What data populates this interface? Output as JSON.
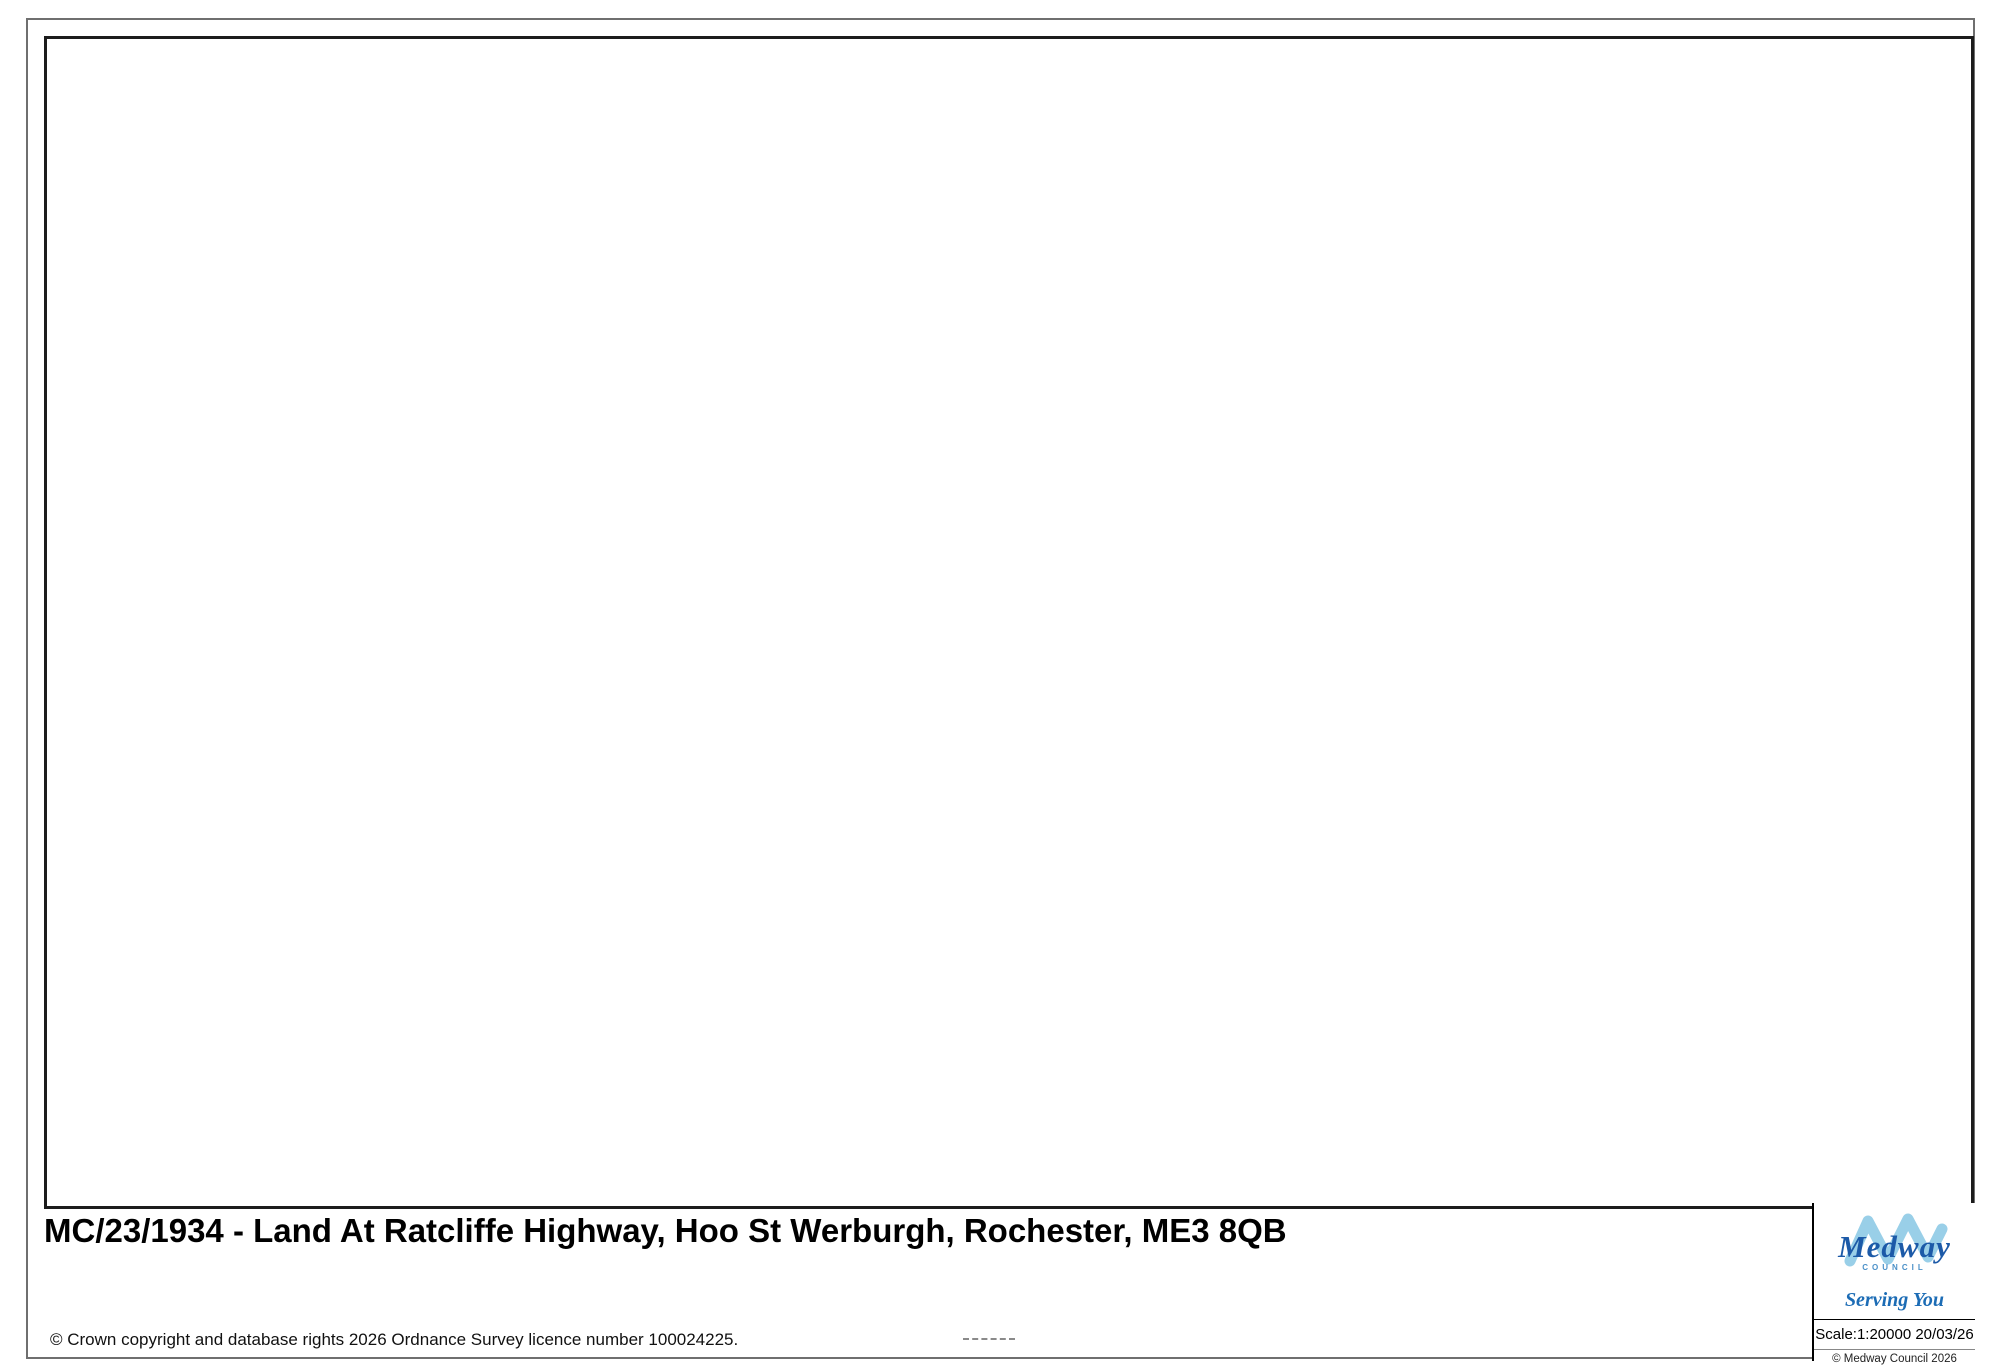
{
  "footer": {
    "title": "MC/23/1934 - Land At Ratcliffe Highway, Hoo St Werburgh, Rochester, ME3 8QB",
    "os_copyright": "© Crown copyright and database rights 2026 Ordnance Survey licence number 100024225.",
    "logo": {
      "name": "Medway",
      "council": "COUNCIL",
      "tagline": "Serving You"
    },
    "scale_text": "Scale:1:20000   20/03/26",
    "scale_label": "Scale:1:20000",
    "date": "20/03/26",
    "council_copyright": "© Medway Council 2026"
  },
  "compass": {
    "n": "N",
    "e": "E",
    "s": "S",
    "w": "W"
  },
  "site": {
    "reference": "MC/23/1934",
    "boundary_points": "967,531 1003,556 1015,559 1031,578 1057,568 1095,649 1013,673 1003,677 960,687 921,561",
    "boundary_color": "#e80012"
  },
  "parking": {
    "label": "P"
  },
  "route_badge": {
    "label": "179",
    "x": 888,
    "y": 883
  },
  "colors": {
    "grid": "#8fd9f2",
    "road_a": "#f170ab",
    "road_minor": "#fdf27b",
    "road_b": "#f5a95e",
    "woodland": "#e9f1db",
    "marsh": "#e6ead9",
    "water": "#d9edf7",
    "builtup": "#f8e7d1",
    "contour": "#f2c5a2",
    "label_grey": "#8c8c8c",
    "label_orange": "#ed9a66",
    "label_pink": "#ee5f9e",
    "route_dot": "#5fcfa5",
    "path_pink": "#f0569f"
  },
  "map": {
    "origin": {
      "x": 44,
      "y": 36
    },
    "labels": [
      {
        "t": "et",
        "x": 62,
        "y": 56,
        "s": 26
      },
      {
        "t": "MEDWAY",
        "x": 762,
        "y": 4,
        "s": 100,
        "ls": 26,
        "c": "#979797"
      },
      {
        "t": "Lodge Hill",
        "x": 327,
        "y": 101,
        "s": 27
      },
      {
        "t": "H O O",
        "x": 245,
        "y": 183,
        "s": 62,
        "ls": 22,
        "c": "#929292"
      },
      {
        "t": "P E N I N S U L A",
        "x": 783,
        "y": 184,
        "s": 62,
        "ls": 6,
        "c": "#929292"
      },
      {
        "t": "74",
        "x": 381,
        "y": 161,
        "s": 25
      },
      {
        "t": "Street",
        "x": 1752,
        "y": 42,
        "s": 36
      },
      {
        "t": "Tu",
        "x": 1962,
        "y": 93,
        "s": 34
      },
      {
        "t": "30",
        "x": 1856,
        "y": 117,
        "s": 26,
        "c": "#ed9a66",
        "r": -15
      },
      {
        "t": "Deangate",
        "x": 1180,
        "y": 260,
        "s": 29
      },
      {
        "t": "43",
        "x": 1151,
        "y": 304,
        "s": 29
      },
      {
        "t": "Tile Barn",
        "x": 1509,
        "y": 338,
        "s": 29
      },
      {
        "t": "Fm",
        "x": 1512,
        "y": 380,
        "s": 29
      },
      {
        "t": "Hoo St",
        "x": 1497,
        "y": 425,
        "s": 64,
        "c": "#8f8f8f"
      },
      {
        "t": "Werburgh",
        "x": 1540,
        "y": 499,
        "s": 64,
        "c": "#8f8f8f"
      },
      {
        "t": "Beluncle",
        "x": 1862,
        "y": 307,
        "s": 29
      },
      {
        "t": "Fm",
        "x": 1913,
        "y": 340,
        "s": 29
      },
      {
        "t": "17",
        "x": 1747,
        "y": 433,
        "s": 26
      },
      {
        "t": "Chattenden",
        "x": 668,
        "y": 512,
        "s": 30
      },
      {
        "t": "Fm",
        "x": 618,
        "y": 555,
        "s": 30
      },
      {
        "t": "62",
        "x": 778,
        "y": 572,
        "s": 26
      },
      {
        "t": "A 228",
        "x": 716,
        "y": 640,
        "s": 38,
        "c": "#ee5f9e",
        "r": -63
      },
      {
        "t": "PH",
        "x": 966,
        "y": 572,
        "s": 30
      },
      {
        "t": "50",
        "x": 984,
        "y": 626,
        "s": 25,
        "c": "#ed9a66",
        "r": -8
      },
      {
        "t": "Stonebridge",
        "x": 968,
        "y": 654,
        "s": 31
      },
      {
        "t": "Acad",
        "x": 972,
        "y": 722,
        "s": 30
      },
      {
        "t": "Broad",
        "x": 843,
        "y": 762,
        "s": 31
      },
      {
        "t": "Street",
        "x": 833,
        "y": 799,
        "s": 31
      },
      {
        "t": "17",
        "x": 1221,
        "y": 744,
        "s": 26
      },
      {
        "t": "30",
        "x": 960,
        "y": 906,
        "s": 25,
        "c": "#ed9a66",
        "r": 185
      },
      {
        "t": "40",
        "x": 858,
        "y": 949,
        "s": 25,
        "c": "#ed9a66",
        "r": 190
      },
      {
        "t": "20",
        "x": 1191,
        "y": 897,
        "s": 25,
        "c": "#ed9a66",
        "r": 200
      },
      {
        "t": "Saxon Shore Way",
        "x": 1232,
        "y": 952,
        "s": 32,
        "ls": 5
      },
      {
        "t": "Chattenden",
        "x": 331,
        "y": 840,
        "s": 40,
        "ls": 3
      },
      {
        "t": "unt",
        "x": 75,
        "y": 855,
        "s": 28
      },
      {
        "t": "Great",
        "x": 46,
        "y": 392,
        "s": 28,
        "a": "l"
      },
      {
        "t": "ttenden",
        "x": 46,
        "y": 424,
        "s": 28,
        "a": "l"
      },
      {
        "t": "Wood",
        "x": 46,
        "y": 459,
        "s": 28,
        "a": "l"
      },
      {
        "t": "Sand &",
        "x": 1804,
        "y": 676,
        "s": 29
      },
      {
        "t": "Gravel Pit",
        "x": 1812,
        "y": 715,
        "s": 29
      },
      {
        "t": "Abbots",
        "x": 1852,
        "y": 820,
        "s": 29
      },
      {
        "t": "Court",
        "x": 1839,
        "y": 859,
        "s": 29
      },
      {
        "t": "59",
        "x": 447,
        "y": 1168,
        "s": 26
      },
      {
        "t": "Beacon",
        "x": 577,
        "y": 1022,
        "s": 29
      },
      {
        "t": "Hill",
        "x": 577,
        "y": 1058,
        "s": 29
      },
      {
        "t": "Hoo Lodge",
        "x": 1128,
        "y": 1030,
        "s": 29
      },
      {
        "t": "10",
        "x": 1382,
        "y": 995,
        "s": 24,
        "c": "#ed9a66",
        "r": 35
      },
      {
        "t": "Saxon Shore Way",
        "x": 1023,
        "y": 1097,
        "s": 32,
        "r": 8,
        "ls": 3
      },
      {
        "t": "Lower",
        "x": 755,
        "y": 1133,
        "s": 40
      },
      {
        "t": "Upnor",
        "x": 757,
        "y": 1176,
        "s": 40
      },
      {
        "t": "PH",
        "x": 607,
        "y": 1189,
        "s": 29
      },
      {
        "t": "Marina",
        "x": 1160,
        "y": 1185,
        "s": 29
      },
      {
        "t": "Ho",
        "x": 1950,
        "y": 1136,
        "s": 30
      }
    ]
  }
}
